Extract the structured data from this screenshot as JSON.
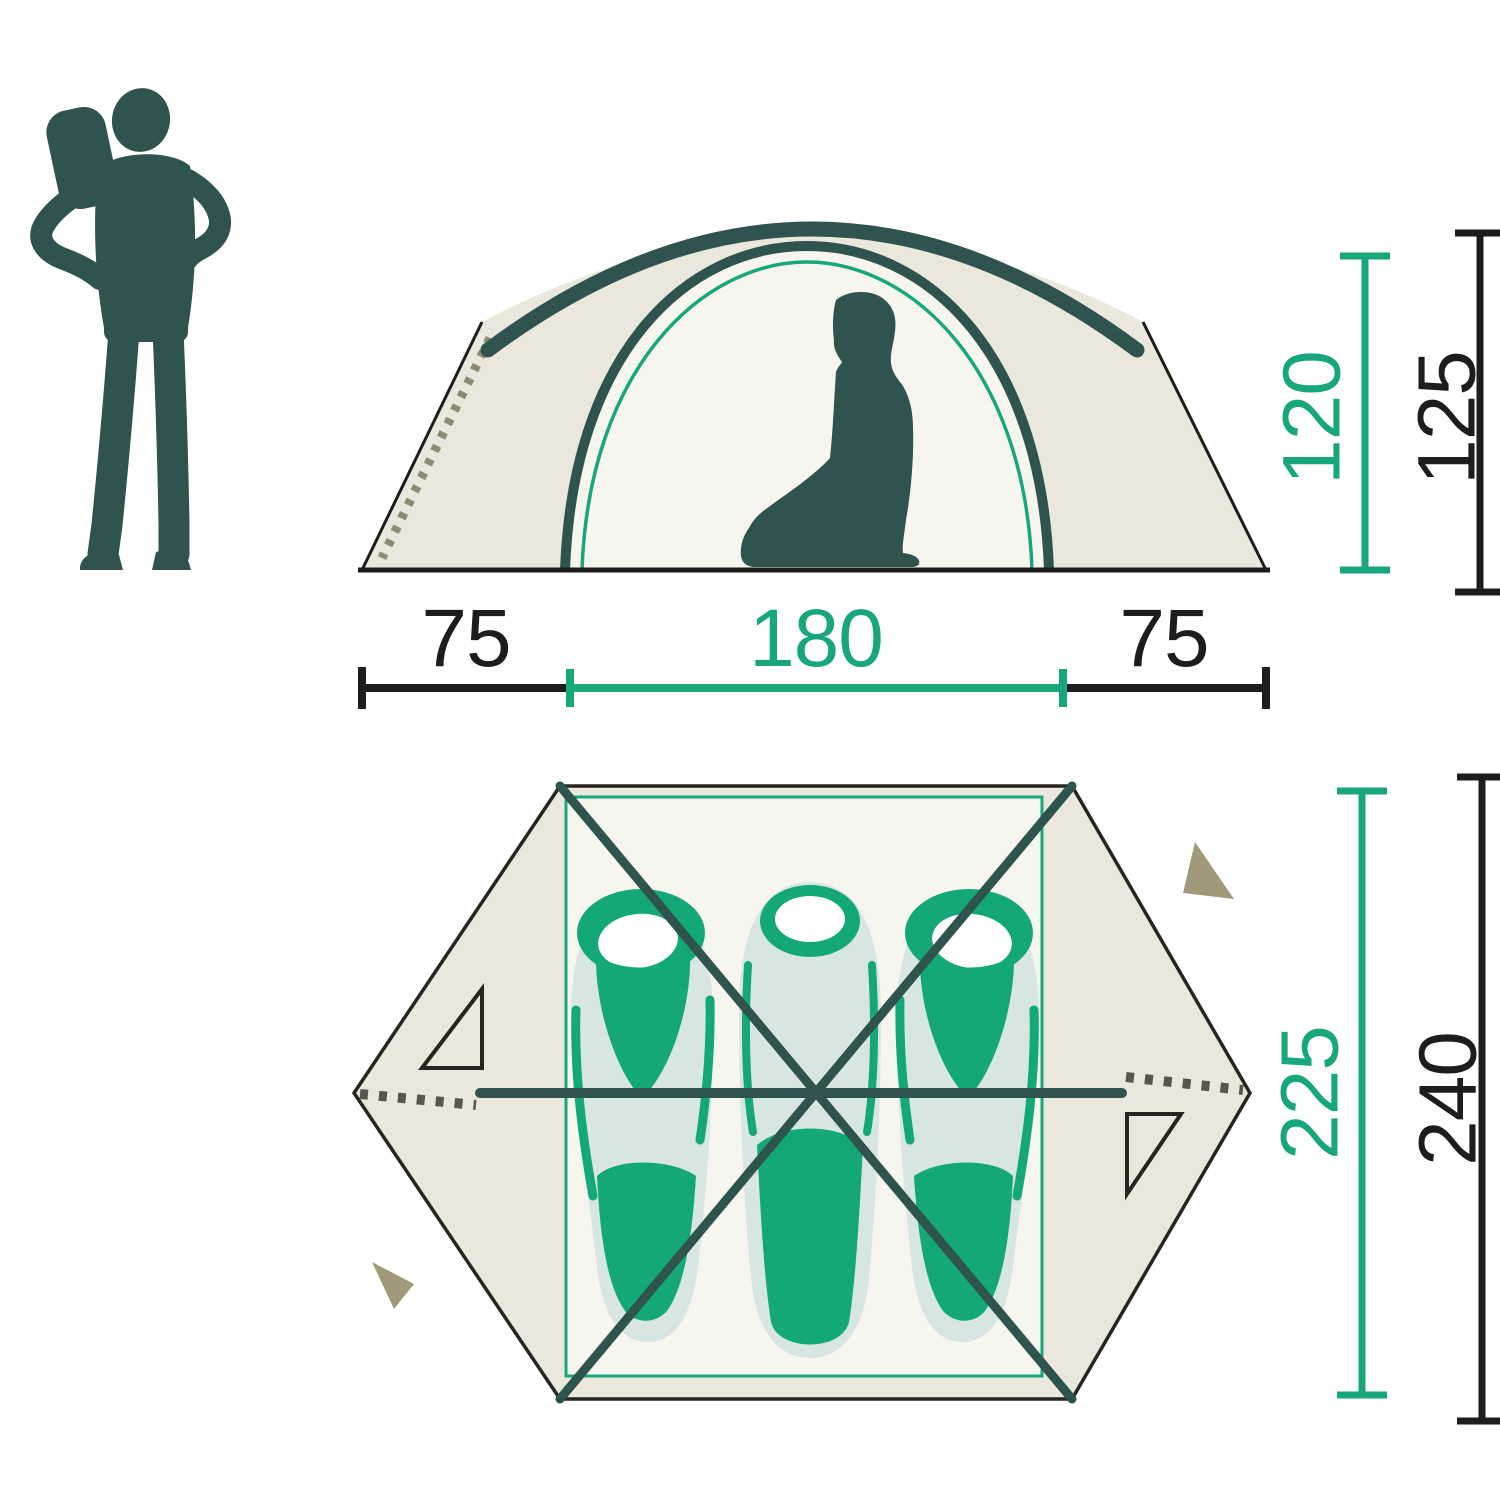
{
  "side_view": {
    "width_left": "75",
    "width_center": "180",
    "width_right": "75",
    "height_inner": "120",
    "height_outer": "125"
  },
  "top_view": {
    "length_inner": "225",
    "length_outer": "240"
  },
  "colors": {
    "accent_green": "#18A77B",
    "pole_teal": "#2F534E",
    "silhouette": "#2F534E",
    "line_black": "#1D1D1B",
    "fabric": "#EAE8DC",
    "fabric_light": "#F7F6EE",
    "bag_blue": "#D8E6E3",
    "bag_green": "#14A879",
    "peg_khaki": "#A2987A",
    "zipper_side": "#8F8B72",
    "zipper_top": "#57574D"
  }
}
